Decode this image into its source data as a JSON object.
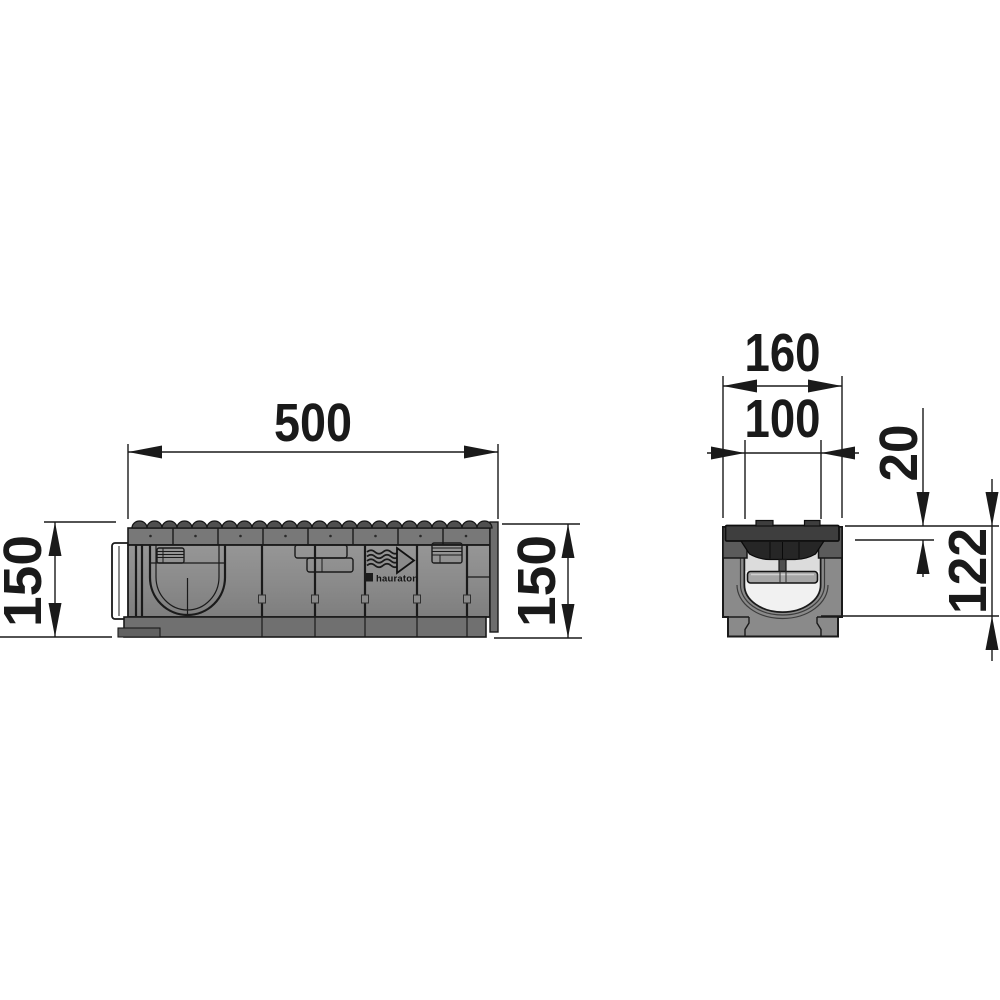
{
  "drawing": {
    "side_view": {
      "dim_length": "500",
      "dim_height_left": "150",
      "dim_height_right": "150",
      "brand_label": "hauraton"
    },
    "cross_section": {
      "dim_width_overall": "160",
      "dim_width_clear": "100",
      "dim_grate_height": "20",
      "dim_channel_depth": "122"
    },
    "icons": {
      "flow_arrow": "flow-direction-right-icon",
      "brand_mark": "hauraton-logo-icon",
      "dimension_arrows": "dimension-arrowhead"
    },
    "colors": {
      "line_color": "#1a1a1a",
      "body_gray": "#8a8a8a",
      "band_gray": "#787878",
      "band_dark": "#707070",
      "grate_dark": "#3e3e3e",
      "bowl_dark": "#262626",
      "bar_gray": "#a6a6a6",
      "interior_light": "#f1f1f1",
      "bg": "#ffffff"
    }
  }
}
